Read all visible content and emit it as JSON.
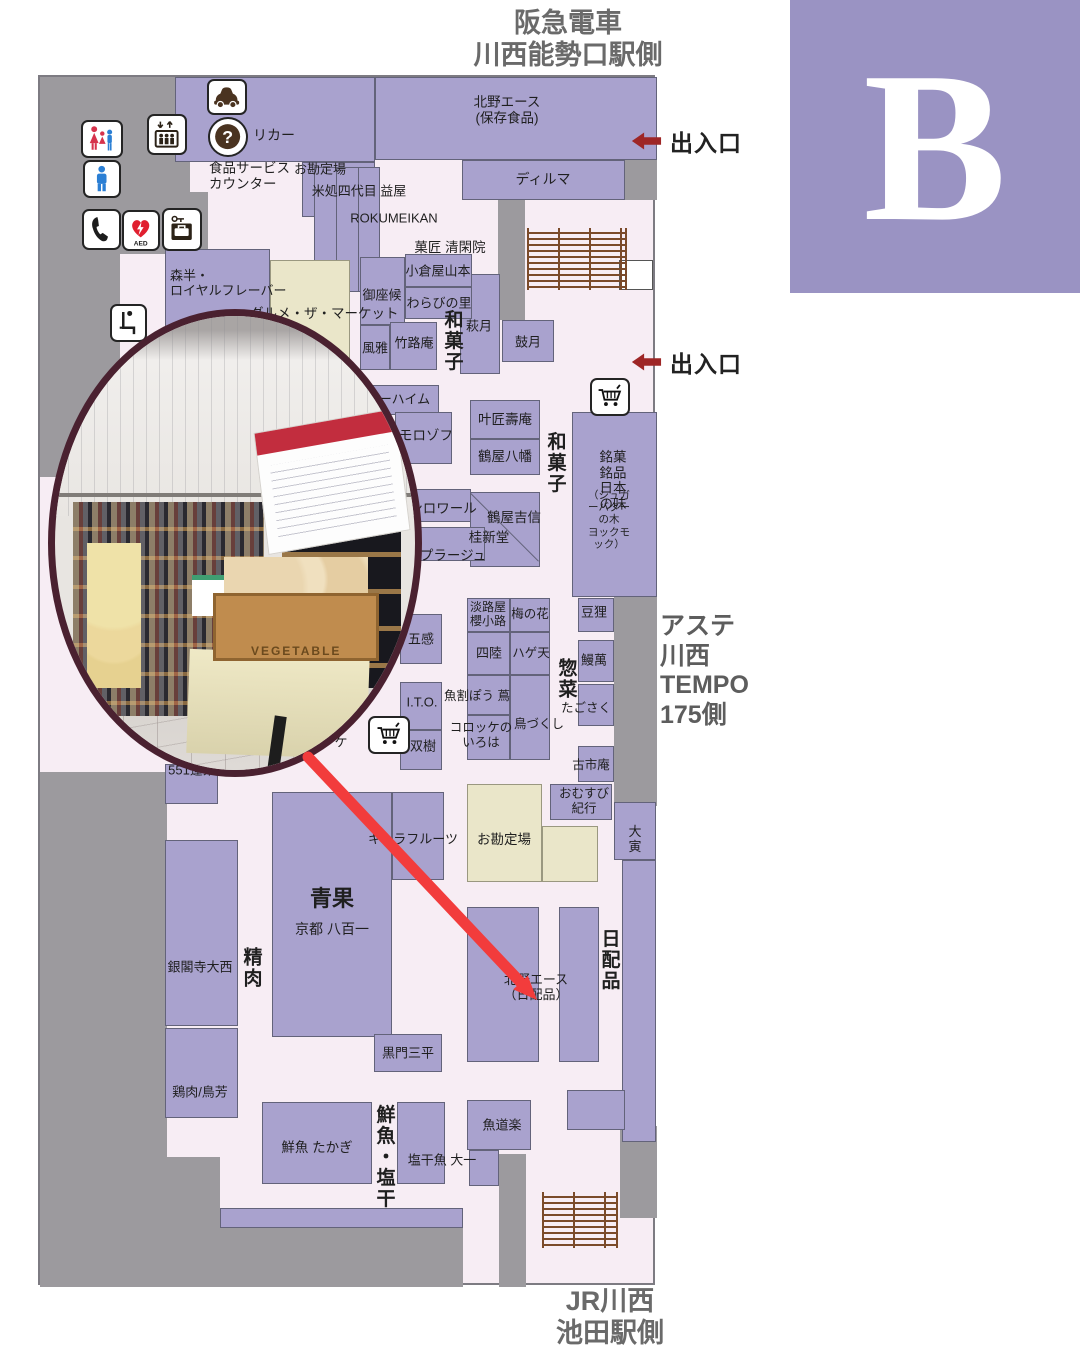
{
  "badge": {
    "label": "B"
  },
  "header": {
    "text": "阪急電車\n川西能勢口駅側"
  },
  "footer": {
    "text": "JR川西\n池田駅側"
  },
  "side_note": {
    "text": "アステ\n川西\nTEMPO\n175側"
  },
  "exits": [
    {
      "label": "出入口",
      "x": 630,
      "y": 137
    },
    {
      "label": "出入口",
      "x": 630,
      "y": 358
    }
  ],
  "map": {
    "x": 38,
    "y": 75,
    "w": 617,
    "h": 1210
  },
  "colors": {
    "floor": "#f7edf4",
    "shop": "#a9a2ce",
    "wall": "#9c9a9e",
    "counter": "#eae6c9",
    "accent_red": "#f23c3c",
    "exit_red": "#9e2626",
    "badge_purple": "#9a93c3",
    "stairs_brown": "#7b4b2a",
    "photo_border": "#4a2130"
  },
  "walls": [
    [
      38,
      75,
      150,
      148
    ],
    [
      38,
      75,
      80,
      400
    ],
    [
      118,
      190,
      88,
      62
    ],
    [
      623,
      152,
      32,
      46
    ],
    [
      496,
      195,
      27,
      123
    ],
    [
      612,
      590,
      43,
      214
    ],
    [
      38,
      770,
      127,
      515
    ],
    [
      165,
      1155,
      53,
      130
    ],
    [
      218,
      1226,
      243,
      59
    ],
    [
      497,
      1152,
      27,
      133
    ],
    [
      618,
      1124,
      37,
      92
    ]
  ],
  "stairs": [
    [
      525,
      226,
      100,
      62
    ],
    [
      540,
      1190,
      76,
      56
    ]
  ],
  "blocks": [
    {
      "n": "shop-liquor",
      "x": 173,
      "y": 75,
      "w": 200,
      "h": 85
    },
    {
      "n": "shop-liquor-2",
      "x": 300,
      "y": 160,
      "w": 73,
      "h": 55
    },
    {
      "n": "shop-kitano-ace-hozon",
      "x": 373,
      "y": 75,
      "w": 282,
      "h": 83
    },
    {
      "n": "shop-dilmah",
      "x": 460,
      "y": 158,
      "w": 163,
      "h": 40
    },
    {
      "n": "checkout-counter-top",
      "x": 312,
      "y": 165,
      "w": 66,
      "h": 125,
      "slats": true
    },
    {
      "n": "shop-hagizuki",
      "x": 458,
      "y": 272,
      "w": 40,
      "h": 100
    },
    {
      "n": "shop-kogetsu",
      "x": 500,
      "y": 318,
      "w": 52,
      "h": 42
    },
    {
      "n": "shop-gozasoro",
      "x": 358,
      "y": 255,
      "w": 45,
      "h": 68
    },
    {
      "n": "shop-oguraya",
      "x": 403,
      "y": 252,
      "w": 67,
      "h": 33
    },
    {
      "n": "shop-warabinosato",
      "x": 403,
      "y": 285,
      "w": 67,
      "h": 32
    },
    {
      "n": "shop-fuga",
      "x": 358,
      "y": 323,
      "w": 30,
      "h": 45
    },
    {
      "n": "shop-chikurouan",
      "x": 388,
      "y": 320,
      "w": 47,
      "h": 48
    },
    {
      "n": "shop-morihan",
      "x": 163,
      "y": 247,
      "w": 105,
      "h": 90
    },
    {
      "n": "counter-gourmet-market",
      "x": 268,
      "y": 258,
      "w": 80,
      "h": 130,
      "t": "c"
    },
    {
      "n": "shop-juchheim",
      "x": 355,
      "y": 383,
      "w": 82,
      "h": 30
    },
    {
      "n": "shop-morozoff",
      "x": 393,
      "y": 410,
      "w": 57,
      "h": 52
    },
    {
      "n": "shop-kanomatsu",
      "x": 468,
      "y": 398,
      "w": 70,
      "h": 39
    },
    {
      "n": "shop-tsuruya-hachiman",
      "x": 468,
      "y": 437,
      "w": 70,
      "h": 36
    },
    {
      "n": "shop-meika-meihin",
      "x": 570,
      "y": 410,
      "w": 85,
      "h": 185
    },
    {
      "n": "shop-monloire",
      "x": 393,
      "y": 487,
      "w": 76,
      "h": 33
    },
    {
      "n": "shop-tsuruya-yoshinobu",
      "x": 468,
      "y": 490,
      "w": 70,
      "h": 75,
      "diag": true
    },
    {
      "n": "shop-plage",
      "x": 393,
      "y": 525,
      "w": 90,
      "h": 34
    },
    {
      "n": "shop-gokan",
      "x": 398,
      "y": 612,
      "w": 42,
      "h": 50
    },
    {
      "n": "shop-ito",
      "x": 398,
      "y": 680,
      "w": 42,
      "h": 48
    },
    {
      "n": "shop-soju",
      "x": 398,
      "y": 728,
      "w": 42,
      "h": 40
    },
    {
      "n": "shop-awajiya",
      "x": 465,
      "y": 596,
      "w": 43,
      "h": 34
    },
    {
      "n": "shop-umenohana",
      "x": 508,
      "y": 596,
      "w": 40,
      "h": 34
    },
    {
      "n": "shop-shiriku",
      "x": 465,
      "y": 630,
      "w": 43,
      "h": 43
    },
    {
      "n": "shop-hageten",
      "x": 508,
      "y": 630,
      "w": 40,
      "h": 43
    },
    {
      "n": "shop-uokappou-tsuta",
      "x": 465,
      "y": 673,
      "w": 43,
      "h": 40
    },
    {
      "n": "shop-torizukushi",
      "x": 508,
      "y": 673,
      "w": 40,
      "h": 85
    },
    {
      "n": "shop-korokke-iroha",
      "x": 465,
      "y": 713,
      "w": 43,
      "h": 45
    },
    {
      "n": "shop-mamedanuki",
      "x": 576,
      "y": 596,
      "w": 36,
      "h": 34
    },
    {
      "n": "shop-unaman",
      "x": 576,
      "y": 638,
      "w": 36,
      "h": 42
    },
    {
      "n": "shop-tagosaku",
      "x": 576,
      "y": 682,
      "w": 36,
      "h": 42
    },
    {
      "n": "shop-furuichian",
      "x": 576,
      "y": 744,
      "w": 36,
      "h": 36
    },
    {
      "n": "shop-omusubi-kiko",
      "x": 548,
      "y": 782,
      "w": 62,
      "h": 36
    },
    {
      "n": "shop-daitora",
      "x": 612,
      "y": 800,
      "w": 42,
      "h": 58
    },
    {
      "n": "shop-right-strip",
      "x": 620,
      "y": 858,
      "w": 34,
      "h": 282
    },
    {
      "n": "shop-kitano-ace-a",
      "x": 465,
      "y": 905,
      "w": 72,
      "h": 155
    },
    {
      "n": "shop-kitano-ace-b",
      "x": 557,
      "y": 905,
      "w": 40,
      "h": 155
    },
    {
      "n": "shop-kimura-fruits",
      "x": 390,
      "y": 790,
      "w": 52,
      "h": 88
    },
    {
      "n": "shop-seika-yaoichi",
      "x": 270,
      "y": 790,
      "w": 120,
      "h": 245
    },
    {
      "n": "shop-kuromon-sanpei",
      "x": 372,
      "y": 1032,
      "w": 68,
      "h": 38
    },
    {
      "n": "checkout-counter-bottom",
      "x": 465,
      "y": 782,
      "w": 75,
      "h": 98,
      "t": "c"
    },
    {
      "n": "checkout-counter-bottom-2",
      "x": 540,
      "y": 824,
      "w": 56,
      "h": 56,
      "t": "c"
    },
    {
      "n": "shop-551-horai",
      "x": 163,
      "y": 762,
      "w": 53,
      "h": 40
    },
    {
      "n": "shop-ginkakuji-onishi",
      "x": 163,
      "y": 838,
      "w": 73,
      "h": 186
    },
    {
      "n": "shop-toriyoshi",
      "x": 163,
      "y": 1026,
      "w": 73,
      "h": 90
    },
    {
      "n": "shop-takagi",
      "x": 260,
      "y": 1100,
      "w": 110,
      "h": 82
    },
    {
      "n": "shop-daiichi",
      "x": 395,
      "y": 1100,
      "w": 48,
      "h": 82
    },
    {
      "n": "shop-uodouraku",
      "x": 465,
      "y": 1098,
      "w": 64,
      "h": 50
    },
    {
      "n": "shop-small",
      "x": 467,
      "y": 1148,
      "w": 30,
      "h": 36
    },
    {
      "n": "bottom-strip",
      "x": 218,
      "y": 1206,
      "w": 243,
      "h": 20
    },
    {
      "n": "shop-corner",
      "x": 565,
      "y": 1088,
      "w": 58,
      "h": 40
    },
    {
      "n": "landing-box",
      "x": 617,
      "y": 258,
      "w": 34,
      "h": 30,
      "t": "w"
    }
  ],
  "texts": [
    {
      "t": "リカー",
      "x": 272,
      "y": 133,
      "s": 14
    },
    {
      "t": "北野エース\n(保存食品)",
      "x": 505,
      "y": 108,
      "s": 13.5
    },
    {
      "t": "食品サービス\nカウンター",
      "x": 207,
      "y": 174,
      "s": 13.5,
      "a": "l"
    },
    {
      "t": "お勘定場",
      "x": 318,
      "y": 167,
      "s": 13
    },
    {
      "t": "米処四代目 益屋",
      "x": 357,
      "y": 189,
      "s": 13
    },
    {
      "t": "ROKUMEIKAN",
      "x": 392,
      "y": 216,
      "s": 13
    },
    {
      "t": "ディルマ",
      "x": 541,
      "y": 177,
      "s": 14
    },
    {
      "t": "菓匠 清閑院",
      "x": 448,
      "y": 246,
      "s": 13.5
    },
    {
      "t": "小倉屋山本",
      "x": 436,
      "y": 269,
      "s": 13
    },
    {
      "t": "わらびの里",
      "x": 437,
      "y": 301,
      "s": 13
    },
    {
      "t": "御座候",
      "x": 380,
      "y": 293,
      "s": 13
    },
    {
      "t": "風雅",
      "x": 373,
      "y": 346,
      "s": 13
    },
    {
      "t": "竹路庵",
      "x": 412,
      "y": 341,
      "s": 13
    },
    {
      "t": "和菓子",
      "x": 450,
      "y": 339,
      "s": 19,
      "w": 1,
      "o": "v"
    },
    {
      "t": "萩月",
      "x": 477,
      "y": 324,
      "s": 13
    },
    {
      "t": "鼓月",
      "x": 526,
      "y": 340,
      "s": 13
    },
    {
      "t": "森半・\nロイヤルフレーバー",
      "x": 168,
      "y": 281,
      "s": 13,
      "a": "l"
    },
    {
      "t": "グルメ・ザ・マーケット",
      "x": 248,
      "y": 312,
      "s": 13.5,
      "a": "l"
    },
    {
      "t": "ユーハイム",
      "x": 396,
      "y": 397,
      "s": 13
    },
    {
      "t": "モロゾフ",
      "x": 424,
      "y": 434,
      "s": 13.5
    },
    {
      "t": "叶匠壽庵",
      "x": 503,
      "y": 418,
      "s": 13.5
    },
    {
      "t": "鶴屋八幡",
      "x": 503,
      "y": 455,
      "s": 13.5
    },
    {
      "t": "和菓子",
      "x": 553,
      "y": 461,
      "s": 19,
      "w": 1,
      "o": "v"
    },
    {
      "t": "銘菓銘品\n日本の味",
      "x": 611,
      "y": 479,
      "s": 13.5
    },
    {
      "t": "（シュガーバターの木\nヨックモック）",
      "x": 607,
      "y": 518,
      "s": 10.5
    },
    {
      "t": "ンロワール",
      "x": 441,
      "y": 507,
      "s": 13.5
    },
    {
      "t": "鶴屋吉信",
      "x": 512,
      "y": 516,
      "s": 13.5
    },
    {
      "t": "桂新堂",
      "x": 487,
      "y": 536,
      "s": 13.5
    },
    {
      "t": "プラージュ",
      "x": 451,
      "y": 554,
      "s": 13.5
    },
    {
      "t": "五感",
      "x": 419,
      "y": 637,
      "s": 13
    },
    {
      "t": "I.T.O.",
      "x": 420,
      "y": 700,
      "s": 13
    },
    {
      "t": "双樹",
      "x": 421,
      "y": 744,
      "s": 13
    },
    {
      "t": "淡路屋\n櫻小路",
      "x": 486,
      "y": 613,
      "s": 12
    },
    {
      "t": "梅の花",
      "x": 528,
      "y": 612,
      "s": 12.5
    },
    {
      "t": "四陸",
      "x": 487,
      "y": 651,
      "s": 13
    },
    {
      "t": "ハゲ天",
      "x": 529,
      "y": 651,
      "s": 12.5
    },
    {
      "t": "惣菜",
      "x": 564,
      "y": 677,
      "s": 19,
      "w": 1,
      "o": "v"
    },
    {
      "t": "魚割ぽう 蔦",
      "x": 475,
      "y": 694,
      "s": 12.5
    },
    {
      "t": "鳥づくし",
      "x": 537,
      "y": 722,
      "s": 12.5
    },
    {
      "t": "コロッケの\nいろは",
      "x": 479,
      "y": 733,
      "s": 12.5
    },
    {
      "t": "たごさく",
      "x": 584,
      "y": 706,
      "s": 12.5
    },
    {
      "t": "豆狸",
      "x": 592,
      "y": 610,
      "s": 13
    },
    {
      "t": "鰻萬",
      "x": 592,
      "y": 658,
      "s": 13
    },
    {
      "t": "古市庵",
      "x": 589,
      "y": 763,
      "s": 12.5
    },
    {
      "t": "おむすび\n紀行",
      "x": 582,
      "y": 799,
      "s": 12.5
    },
    {
      "t": "大寅",
      "x": 633,
      "y": 837,
      "s": 13
    },
    {
      "t": "日配品",
      "x": 607,
      "y": 958,
      "s": 19,
      "w": 1,
      "o": "v"
    },
    {
      "t": "北野エース\n（日配品）",
      "x": 534,
      "y": 985,
      "s": 13
    },
    {
      "t": "お勘定場",
      "x": 502,
      "y": 838,
      "s": 13.5
    },
    {
      "t": "キムラフルーツ",
      "x": 411,
      "y": 837,
      "s": 13
    },
    {
      "t": "青果",
      "x": 330,
      "y": 897,
      "s": 22,
      "w": 1
    },
    {
      "t": "京都 八百一",
      "x": 330,
      "y": 927,
      "s": 14
    },
    {
      "t": "精肉",
      "x": 249,
      "y": 966,
      "s": 19,
      "w": 1,
      "o": "v"
    },
    {
      "t": "銀閣寺大西",
      "x": 198,
      "y": 965,
      "s": 13
    },
    {
      "t": "551蓬莱",
      "x": 190,
      "y": 768,
      "s": 13
    },
    {
      "t": "鶏肉/鳥芳",
      "x": 198,
      "y": 1090,
      "s": 13
    },
    {
      "t": "黒門三平",
      "x": 406,
      "y": 1051,
      "s": 13
    },
    {
      "t": "鮮魚 たかぎ",
      "x": 315,
      "y": 1146,
      "s": 13.5
    },
    {
      "t": "鮮魚・塩干",
      "x": 382,
      "y": 1155,
      "s": 19,
      "w": 1,
      "o": "v"
    },
    {
      "t": "塩干魚 大一",
      "x": 440,
      "y": 1158,
      "s": 13
    },
    {
      "t": "魚道楽",
      "x": 500,
      "y": 1123,
      "s": 13
    },
    {
      "t": "ケ",
      "x": 339,
      "y": 740,
      "s": 13
    }
  ],
  "icons": [
    {
      "g": "car",
      "n": "car-service-icon",
      "x": 205,
      "y": 77,
      "w": 40,
      "h": 36
    },
    {
      "g": "question",
      "n": "information-icon",
      "x": 206,
      "y": 115,
      "w": 40,
      "h": 40,
      "round": true
    },
    {
      "g": "elevator",
      "n": "elevator-icon",
      "x": 145,
      "y": 112,
      "w": 40,
      "h": 41
    },
    {
      "g": "restroom-family",
      "n": "restroom-women-icon",
      "x": 79,
      "y": 118,
      "w": 42,
      "h": 38
    },
    {
      "g": "restroom-men",
      "n": "restroom-men-icon",
      "x": 81,
      "y": 158,
      "w": 38,
      "h": 38
    },
    {
      "g": "phone",
      "n": "public-phone-icon",
      "x": 80,
      "y": 207,
      "w": 39,
      "h": 41
    },
    {
      "g": "aed",
      "n": "aed-icon",
      "x": 120,
      "y": 208,
      "w": 38,
      "h": 41
    },
    {
      "g": "locker",
      "n": "coin-locker-icon",
      "x": 160,
      "y": 206,
      "w": 40,
      "h": 43
    },
    {
      "g": "seat",
      "n": "rest-area-icon",
      "x": 108,
      "y": 302,
      "w": 37,
      "h": 38
    },
    {
      "g": "cart",
      "n": "cart-icon",
      "x": 588,
      "y": 376,
      "w": 40,
      "h": 38
    },
    {
      "g": "cart",
      "n": "cart-icon",
      "x": 366,
      "y": 714,
      "w": 42,
      "h": 38
    }
  ],
  "photo": {
    "x": 48,
    "y": 309,
    "w": 374,
    "h": 468,
    "crate_label": "VEGETABLE"
  },
  "annotation": {
    "arrow": {
      "x1": 308,
      "y1": 757,
      "x2": 524,
      "y2": 986,
      "tip_x": 537,
      "tip_y": 1000
    },
    "circle": {
      "cx": 552,
      "cy": 1057,
      "r": 57
    }
  }
}
